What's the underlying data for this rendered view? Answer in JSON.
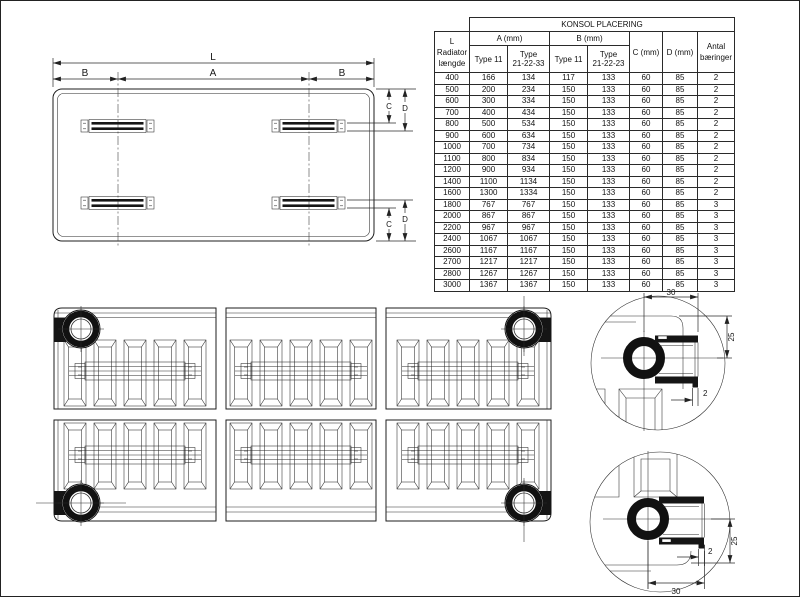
{
  "colors": {
    "line": "#1e1e1e",
    "background": "#ffffff"
  },
  "topview": {
    "dim_l": "L",
    "dim_b_left": "B",
    "dim_a": "A",
    "dim_b_right": "B",
    "dim_c_top": "C",
    "dim_d_top": "D",
    "dim_c_bottom": "C",
    "dim_d_bottom": "D"
  },
  "table": {
    "title": "KONSOL PLACERING",
    "col_l_header": "L\nRadiator\nlængde",
    "group_a": "A (mm)",
    "group_b": "B (mm)",
    "sub_a_type11": "Type 11",
    "sub_a_type21": "Type\n21-22-33",
    "sub_b_type11": "Type 11",
    "sub_b_type21": "Type\n21-22-23",
    "col_c": "C (mm)",
    "col_d": "D (mm)",
    "col_antal": "Antal\nbæringer",
    "rows": [
      [
        400,
        166,
        134,
        117,
        133,
        60,
        85,
        2
      ],
      [
        500,
        200,
        234,
        150,
        133,
        60,
        85,
        2
      ],
      [
        600,
        300,
        334,
        150,
        133,
        60,
        85,
        2
      ],
      [
        700,
        400,
        434,
        150,
        133,
        60,
        85,
        2
      ],
      [
        800,
        500,
        534,
        150,
        133,
        60,
        85,
        2
      ],
      [
        900,
        600,
        634,
        150,
        133,
        60,
        85,
        2
      ],
      [
        1000,
        700,
        734,
        150,
        133,
        60,
        85,
        2
      ],
      [
        1100,
        800,
        834,
        150,
        133,
        60,
        85,
        2
      ],
      [
        1200,
        900,
        934,
        150,
        133,
        60,
        85,
        2
      ],
      [
        1400,
        1100,
        1134,
        150,
        133,
        60,
        85,
        2
      ],
      [
        1600,
        1300,
        1334,
        150,
        133,
        60,
        85,
        2
      ],
      [
        1800,
        767,
        767,
        150,
        133,
        60,
        85,
        3
      ],
      [
        2000,
        867,
        867,
        150,
        133,
        60,
        85,
        3
      ],
      [
        2200,
        967,
        967,
        150,
        133,
        60,
        85,
        3
      ],
      [
        2400,
        1067,
        1067,
        150,
        133,
        60,
        85,
        3
      ],
      [
        2600,
        1167,
        1167,
        150,
        133,
        60,
        85,
        3
      ],
      [
        2700,
        1217,
        1217,
        150,
        133,
        60,
        85,
        3
      ],
      [
        2800,
        1267,
        1267,
        150,
        133,
        60,
        85,
        3
      ],
      [
        3000,
        1367,
        1367,
        150,
        133,
        60,
        85,
        3
      ]
    ]
  },
  "detail_top": {
    "dim_width": "30",
    "dim_height": "25",
    "dim_lip": "2"
  },
  "detail_bottom": {
    "dim_width": "30",
    "dim_height": "25",
    "dim_lip": "2"
  }
}
